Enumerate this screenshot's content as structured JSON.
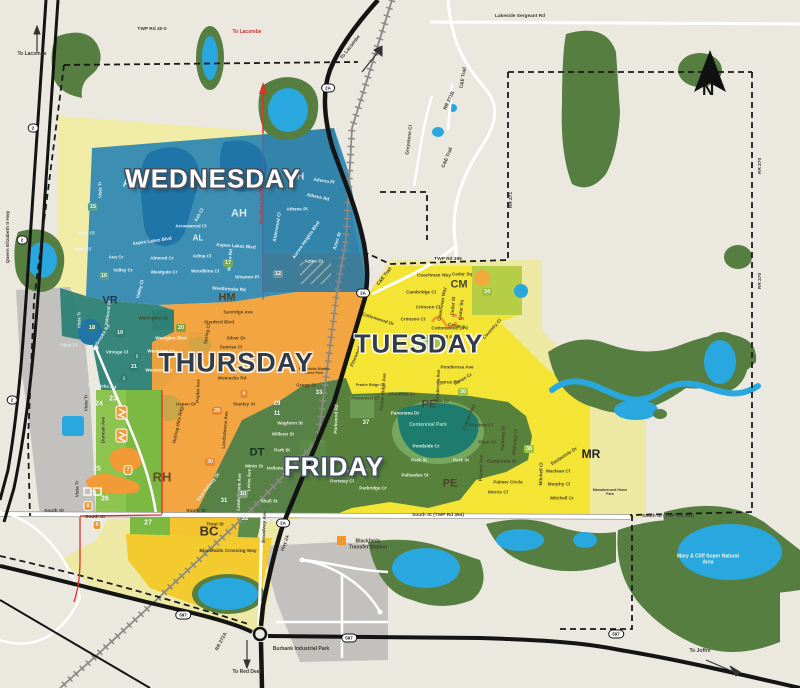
{
  "map_name": "town-collection-day-zone-map",
  "colors": {
    "background": "#EBE8E0",
    "wednesday_blue": "#2E86AF",
    "thursday_orange": "#F2A23B",
    "tuesday_yellow": "#F4E32F",
    "friday_green": "#4E7A3C",
    "pale_yellow": "#EDE9A5",
    "bright_green": "#7CB942",
    "teal_zone": "#2C8175",
    "forest": "#567E41",
    "water": "#29A8DF",
    "industrial_gray": "#C2C1BD",
    "road_red": "#E03127"
  },
  "north": {
    "t": "N"
  },
  "day_zones": [
    {
      "t": "WEDNESDAY",
      "x": 213,
      "y": 179,
      "style": "light",
      "s": 26
    },
    {
      "t": "THURSDAY",
      "x": 236,
      "y": 363,
      "style": "dark",
      "s": 27
    },
    {
      "t": "TUESDAY",
      "x": 419,
      "y": 344,
      "style": "dark",
      "s": 26
    },
    {
      "t": "FRIDAY",
      "x": 334,
      "y": 467,
      "style": "light",
      "s": 26
    }
  ],
  "area_codes": [
    {
      "t": "AL",
      "x": 130,
      "y": 184,
      "s": 11,
      "c": "#D8ECF4"
    },
    {
      "t": "AL",
      "x": 198,
      "y": 238,
      "s": 8,
      "c": "#D8ECF4"
    },
    {
      "t": "AH",
      "x": 297,
      "y": 177,
      "s": 10,
      "c": "#D8ECF4"
    },
    {
      "t": "AH",
      "x": 239,
      "y": 214,
      "s": 11,
      "c": "#D8ECF4"
    },
    {
      "t": "VR",
      "x": 110,
      "y": 301,
      "s": 11,
      "c": "#1F3B54"
    },
    {
      "t": "HM",
      "x": 227,
      "y": 298,
      "s": 11,
      "c": "#54421F"
    },
    {
      "t": "CM",
      "x": 459,
      "y": 285,
      "s": 11,
      "c": "#4A452E"
    },
    {
      "t": "PE",
      "x": 429,
      "y": 405,
      "s": 11,
      "c": "#4A452E"
    },
    {
      "t": "PE",
      "x": 450,
      "y": 484,
      "s": 11,
      "c": "#4A452E"
    },
    {
      "t": "RH",
      "x": 162,
      "y": 478,
      "s": 13,
      "c": "#6B4A23"
    },
    {
      "t": "DT",
      "x": 257,
      "y": 453,
      "s": 11,
      "c": "#17301F"
    },
    {
      "t": "BC",
      "x": 209,
      "y": 532,
      "s": 13,
      "c": "#37352C"
    },
    {
      "t": "MR",
      "x": 591,
      "y": 455,
      "s": 12,
      "c": "#22211C"
    }
  ],
  "badges": [
    {
      "t": "15",
      "x": 93,
      "y": 207,
      "bg": "#55A08F"
    },
    {
      "t": "16",
      "x": 104,
      "y": 276,
      "bg": "#55A08F"
    },
    {
      "t": "17",
      "x": 228,
      "y": 263,
      "bg": "#79A855"
    },
    {
      "t": "12",
      "x": 278,
      "y": 274,
      "bg": "#7195A0"
    },
    {
      "t": "18",
      "x": 92,
      "y": 328,
      "bg": "#2F7F72"
    },
    {
      "t": "19",
      "x": 120,
      "y": 333,
      "bg": "#2F7F72"
    },
    {
      "t": "20",
      "x": 181,
      "y": 328,
      "bg": "#7FA33C"
    },
    {
      "t": "2",
      "x": 137,
      "y": 356,
      "bg": "#2F7F72",
      "s": 4.5
    },
    {
      "t": "21",
      "x": 134,
      "y": 367,
      "bg": "#2F7F72"
    },
    {
      "t": "1",
      "x": 124,
      "y": 378,
      "bg": "#2F7F72",
      "s": 4.5
    },
    {
      "t": "4",
      "x": 244,
      "y": 394,
      "bg": "#E8882F"
    },
    {
      "t": "28",
      "x": 217,
      "y": 411,
      "bg": "#E8882F"
    },
    {
      "t": "30",
      "x": 210,
      "y": 462,
      "bg": "#E8882F"
    },
    {
      "t": "23",
      "x": 113,
      "y": 399,
      "bg": "none",
      "s": 7
    },
    {
      "t": "24",
      "x": 99,
      "y": 404,
      "bg": "none",
      "s": 7
    },
    {
      "t": "25",
      "x": 97,
      "y": 469,
      "bg": "none",
      "s": 7
    },
    {
      "t": "26",
      "x": 105,
      "y": 499,
      "bg": "none",
      "s": 7
    },
    {
      "t": "27",
      "x": 148,
      "y": 523,
      "bg": "none",
      "s": 7
    },
    {
      "t": "7",
      "x": 128,
      "y": 470,
      "bg": "#F09A30",
      "brd": 1
    },
    {
      "t": "8",
      "x": 88,
      "y": 506,
      "bg": "#F09A30",
      "brd": 1
    },
    {
      "t": "9",
      "x": 97,
      "y": 525,
      "bg": "#F09A30",
      "brd": 1
    },
    {
      "t": "10",
      "x": 243,
      "y": 494,
      "bg": "#84A284"
    },
    {
      "t": "31",
      "x": 224,
      "y": 501,
      "bg": "none",
      "s": 6
    },
    {
      "t": "32",
      "x": 245,
      "y": 519,
      "bg": "none",
      "s": 6
    },
    {
      "t": "29",
      "x": 277,
      "y": 404,
      "bg": "none",
      "s": 6
    },
    {
      "t": "11",
      "x": 277,
      "y": 414,
      "bg": "none",
      "s": 6
    },
    {
      "t": "33",
      "x": 319,
      "y": 393,
      "bg": "none",
      "s": 6
    },
    {
      "t": "34",
      "x": 487,
      "y": 292,
      "bg": "#9DC43B"
    },
    {
      "t": "36",
      "x": 463,
      "y": 392,
      "bg": "#9DC43B"
    },
    {
      "t": "37",
      "x": 366,
      "y": 423,
      "bg": "none",
      "s": 6
    },
    {
      "t": "38",
      "x": 529,
      "y": 449,
      "bg": "#9DC43B"
    }
  ],
  "shields": [
    {
      "t": "2A",
      "x": 328,
      "y": 88
    },
    {
      "t": "2A",
      "x": 363,
      "y": 293
    },
    {
      "t": "2A",
      "x": 283,
      "y": 523
    },
    {
      "t": "2",
      "x": 33,
      "y": 128
    },
    {
      "t": "2",
      "x": 22,
      "y": 240
    },
    {
      "t": "2",
      "x": 12,
      "y": 400
    },
    {
      "t": "597",
      "x": 183,
      "y": 615
    },
    {
      "t": "597",
      "x": 349,
      "y": 638
    },
    {
      "t": "597",
      "x": 616,
      "y": 634
    }
  ],
  "roads": [
    {
      "t": "Lakeside Sergeant Rd",
      "x": 520,
      "y": 17
    },
    {
      "t": "TWP Rd 40-0",
      "x": 152,
      "y": 30
    },
    {
      "t": "TWP Rd 395",
      "x": 448,
      "y": 260
    },
    {
      "t": "South St",
      "x": 54,
      "y": 512
    },
    {
      "t": "South St",
      "x": 95,
      "y": 518
    },
    {
      "t": "South St",
      "x": 196,
      "y": 512
    },
    {
      "t": "South St (TWP Rd 394)",
      "x": 438,
      "y": 516,
      "b": 1
    },
    {
      "t": "South St (TWP Rd 394)",
      "x": 668,
      "y": 517,
      "b": 1
    },
    {
      "t": "Queen Elizabeth II Hwy",
      "x": 9,
      "y": 237,
      "r": -90
    },
    {
      "t": "C&E Trail",
      "x": 464,
      "y": 78,
      "r": -80
    },
    {
      "t": "C&E Trail",
      "x": 448,
      "y": 158,
      "r": -68
    },
    {
      "t": "C&E Trail",
      "x": 385,
      "y": 277,
      "r": -52
    },
    {
      "t": "Greystone Cl",
      "x": 410,
      "y": 140,
      "r": -83
    },
    {
      "t": "RR 271B",
      "x": 450,
      "y": 101,
      "r": -65
    },
    {
      "t": "RR 271",
      "x": 512,
      "y": 200,
      "r": -90
    },
    {
      "t": "RR 270",
      "x": 761,
      "y": 166,
      "r": -90
    },
    {
      "t": "RR 270",
      "x": 761,
      "y": 281,
      "r": -90
    },
    {
      "t": "RR 272A",
      "x": 222,
      "y": 642,
      "r": -62
    },
    {
      "t": "Blackfalds Crossing Way",
      "x": 228,
      "y": 552,
      "b": 1
    }
  ],
  "places": [
    {
      "t": "To Lacombe",
      "x": 32,
      "y": 55,
      "b": 1
    },
    {
      "t": "To Lacombe",
      "x": 247,
      "y": 33,
      "b": 1,
      "c": "#C8362E"
    },
    {
      "t": "To Lacombe",
      "x": 351,
      "y": 48,
      "b": 1,
      "r": -52
    },
    {
      "t": "To Red Deer",
      "x": 247,
      "y": 673,
      "b": 1
    },
    {
      "t": "To Joffre",
      "x": 700,
      "y": 652,
      "b": 1
    },
    {
      "t": "Burbank Industrial Park",
      "x": 301,
      "y": 650,
      "b": 1,
      "s": 5
    },
    {
      "t": "Blackfalds Transfer Station",
      "x": 368,
      "y": 545,
      "b": 1,
      "wd": 44
    },
    {
      "t": "Mary & Cliff Soper Natural Area",
      "x": 708,
      "y": 560,
      "b": 1,
      "c": "#F2F7EC",
      "wd": 64
    },
    {
      "t": "Centennial Park",
      "x": 428,
      "y": 426,
      "c": "#9FD9C8",
      "wd": 40
    },
    {
      "t": "Blackfalds Mobile Home Park",
      "x": 314,
      "y": 371,
      "c": "#54421F",
      "wd": 40,
      "s": 3.6
    },
    {
      "t": "Manufactured Home Park",
      "x": 610,
      "y": 492,
      "c": "#3E3A33",
      "wd": 42,
      "s": 3.6
    }
  ],
  "streets": [
    {
      "t": "Vista Tr",
      "x": 100,
      "y": 190,
      "r": -90,
      "c": "#EAF4F8"
    },
    {
      "t": "Anna Cl",
      "x": 86,
      "y": 233,
      "c": "#EAF4F8"
    },
    {
      "t": "Arlen Cl",
      "x": 82,
      "y": 249,
      "c": "#EAF4F8"
    },
    {
      "t": "Ava Cr",
      "x": 116,
      "y": 257,
      "c": "#EAF4F8"
    },
    {
      "t": "Aspen Lakes Blvd",
      "x": 152,
      "y": 241,
      "r": -8,
      "c": "#EAF4F8"
    },
    {
      "t": "Aspen Lakes Blvd",
      "x": 236,
      "y": 246,
      "r": 4,
      "c": "#EAF4F8"
    },
    {
      "t": "Almond Cr",
      "x": 162,
      "y": 258,
      "c": "#EAF4F8"
    },
    {
      "t": "Westgate Cr",
      "x": 164,
      "y": 272,
      "c": "#EAF4F8"
    },
    {
      "t": "Valley Cr",
      "x": 123,
      "y": 270,
      "c": "#EAF4F8"
    },
    {
      "t": "Valley Cl",
      "x": 140,
      "y": 289,
      "r": -75,
      "c": "#EAF4F8"
    },
    {
      "t": "Adina Cl",
      "x": 202,
      "y": 256,
      "c": "#EAF4F8"
    },
    {
      "t": "Woodbine Cl",
      "x": 205,
      "y": 271,
      "c": "#EAF4F8"
    },
    {
      "t": "Winston Pl",
      "x": 247,
      "y": 277,
      "c": "#EAF4F8"
    },
    {
      "t": "Westbrooke Rd",
      "x": 229,
      "y": 289,
      "r": 3,
      "c": "#EAF4F8"
    },
    {
      "t": "Arrowwood Cl",
      "x": 191,
      "y": 226,
      "c": "#EAF4F8"
    },
    {
      "t": "Ash Cl",
      "x": 199,
      "y": 215,
      "r": -60,
      "c": "#EAF4F8"
    },
    {
      "t": "Willow Rd",
      "x": 230,
      "y": 260,
      "r": -85,
      "c": "#EAF4F8"
    },
    {
      "t": "Athena Pl",
      "x": 324,
      "y": 181,
      "r": 8,
      "c": "#EAF4F8"
    },
    {
      "t": "Athens Rd",
      "x": 318,
      "y": 197,
      "r": 12,
      "c": "#EAF4F8"
    },
    {
      "t": "Athens Pl",
      "x": 297,
      "y": 209,
      "c": "#EAF4F8"
    },
    {
      "t": "Alderwood Cl",
      "x": 277,
      "y": 227,
      "r": -80,
      "c": "#EAF4F8"
    },
    {
      "t": "Aurora Heights Blvd",
      "x": 306,
      "y": 240,
      "r": -55,
      "c": "#EAF4F8"
    },
    {
      "t": "Aztec St",
      "x": 337,
      "y": 241,
      "r": -72,
      "c": "#EAF4F8"
    },
    {
      "t": "Aztec Cr",
      "x": 314,
      "y": 261,
      "c": "#EAF4F8"
    },
    {
      "t": "Broadway Ave/RR 272",
      "x": 261,
      "y": 200,
      "r": -90,
      "c": "#C8362E"
    },
    {
      "t": "Vista Tr",
      "x": 79,
      "y": 320,
      "r": -90,
      "c": "#DDEEEA"
    },
    {
      "t": "Valmond St",
      "x": 108,
      "y": 313,
      "r": -82,
      "c": "#DDEEEA"
    },
    {
      "t": "Vista Cl",
      "x": 69,
      "y": 345,
      "c": "#DDEEEA"
    },
    {
      "t": "Westbrooke Rd",
      "x": 100,
      "y": 339,
      "r": -58,
      "c": "#DDEEEA"
    },
    {
      "t": "Vintage Cl",
      "x": 117,
      "y": 352,
      "c": "#DDEEEA"
    },
    {
      "t": "Womacks Rd",
      "x": 102,
      "y": 386,
      "r": 6,
      "c": "#DDEEEA"
    },
    {
      "t": "Wellington Cl",
      "x": 153,
      "y": 318,
      "c": "#54421F"
    },
    {
      "t": "Sunridge Ave",
      "x": 238,
      "y": 312,
      "c": "#54421F"
    },
    {
      "t": "Stanford Blvd",
      "x": 219,
      "y": 322,
      "c": "#54421F"
    },
    {
      "t": "Silver Dr",
      "x": 236,
      "y": 338,
      "c": "#54421F"
    },
    {
      "t": "Sunrise Cl",
      "x": 231,
      "y": 347,
      "c": "#54421F"
    },
    {
      "t": "Spring Cl",
      "x": 207,
      "y": 334,
      "r": -80,
      "c": "#54421F"
    },
    {
      "t": "Westglen Blvd",
      "x": 171,
      "y": 338,
      "c": "#FFF8EC"
    },
    {
      "t": "Westview Cr",
      "x": 161,
      "y": 351,
      "c": "#FFF8EC"
    },
    {
      "t": "Westview Cr",
      "x": 159,
      "y": 370,
      "c": "#FFF8EC"
    },
    {
      "t": "Womacks Rd",
      "x": 232,
      "y": 378,
      "c": "#54421F"
    },
    {
      "t": "Stanley St",
      "x": 244,
      "y": 404,
      "c": "#54421F"
    },
    {
      "t": "Aspen Dr",
      "x": 186,
      "y": 404,
      "c": "#54421F"
    },
    {
      "t": "Poplar Ave",
      "x": 198,
      "y": 391,
      "r": -88,
      "c": "#54421F"
    },
    {
      "t": "Rolling Hills Rdg",
      "x": 178,
      "y": 425,
      "r": -78,
      "c": "#54421F"
    },
    {
      "t": "Landsdowne Ave",
      "x": 225,
      "y": 430,
      "r": -85,
      "c": "#54421F"
    },
    {
      "t": "Gregg St",
      "x": 306,
      "y": 385,
      "c": "#54421F"
    },
    {
      "t": "Coachman Way",
      "x": 434,
      "y": 275,
      "c": "#4A452E"
    },
    {
      "t": "Cedar Sq",
      "x": 462,
      "y": 274,
      "c": "#4A452E"
    },
    {
      "t": "Cambridge Cl",
      "x": 421,
      "y": 292,
      "c": "#4A452E"
    },
    {
      "t": "Crimson Cl",
      "x": 428,
      "y": 307,
      "c": "#4A452E"
    },
    {
      "t": "Crimson Ct",
      "x": 413,
      "y": 319,
      "c": "#4A452E"
    },
    {
      "t": "Coachman Way",
      "x": 442,
      "y": 304,
      "r": -80,
      "c": "#4A452E"
    },
    {
      "t": "Cedar St",
      "x": 453,
      "y": 306,
      "r": -85,
      "c": "#4A452E"
    },
    {
      "t": "Cedar Sq",
      "x": 461,
      "y": 310,
      "r": -85,
      "c": "#4A452E"
    },
    {
      "t": "Cedar Sq",
      "x": 458,
      "y": 326,
      "r": 10,
      "c": "#4A452E"
    },
    {
      "t": "Cottonwood Dr",
      "x": 448,
      "y": 328,
      "c": "#4A452E"
    },
    {
      "t": "Cottonwood Dr",
      "x": 378,
      "y": 319,
      "r": 18,
      "c": "#4A452E"
    },
    {
      "t": "Churchill Pl",
      "x": 441,
      "y": 337,
      "c": "#4A452E"
    },
    {
      "t": "Coventry Cl",
      "x": 492,
      "y": 329,
      "r": -48,
      "c": "#4A452E"
    },
    {
      "t": "Ponderosa Ave",
      "x": 457,
      "y": 367,
      "c": "#4A452E"
    },
    {
      "t": "Ponderosa Ave",
      "x": 438,
      "y": 386,
      "r": -88,
      "c": "#4A452E"
    },
    {
      "t": "Cyprus Rd",
      "x": 448,
      "y": 382,
      "c": "#4A452E"
    },
    {
      "t": "Inman Cr",
      "x": 463,
      "y": 379,
      "r": -30,
      "c": "#4A452E"
    },
    {
      "t": "Plumtree Cr",
      "x": 402,
      "y": 394,
      "c": "#4A452E"
    },
    {
      "t": "Prairie Ridge Ave",
      "x": 383,
      "y": 392,
      "r": -85,
      "c": "#4A452E"
    },
    {
      "t": "Prairie Ridge Cl",
      "x": 370,
      "y": 385,
      "s": 3.8,
      "c": "#4A452E"
    },
    {
      "t": "Pinewood Cl",
      "x": 365,
      "y": 398,
      "c": "#4A452E"
    },
    {
      "t": "Pinewood Rd",
      "x": 357,
      "y": 353,
      "r": -68,
      "c": "#4A452E"
    },
    {
      "t": "Pine Cr",
      "x": 441,
      "y": 401,
      "c": "#4A452E"
    },
    {
      "t": "Pioneer Way",
      "x": 469,
      "y": 417,
      "r": -68,
      "c": "#4A452E"
    },
    {
      "t": "Pinetree Cl",
      "x": 481,
      "y": 425,
      "c": "#4A452E"
    },
    {
      "t": "Piper Cl",
      "x": 487,
      "y": 442,
      "c": "#4A452E"
    },
    {
      "t": "Parkway Dr",
      "x": 503,
      "y": 438,
      "r": -88,
      "c": "#4A452E"
    },
    {
      "t": "McKinley Cl",
      "x": 515,
      "y": 442,
      "r": -85,
      "c": "#4A452E"
    },
    {
      "t": "Eastpointe Dr",
      "x": 502,
      "y": 461,
      "c": "#4A452E"
    },
    {
      "t": "Eastpointe Dr",
      "x": 564,
      "y": 456,
      "r": -32,
      "c": "#4A452E"
    },
    {
      "t": "Pioneer Ave",
      "x": 481,
      "y": 468,
      "r": -88,
      "c": "#4A452E"
    },
    {
      "t": "Palmer Circle",
      "x": 508,
      "y": 482,
      "c": "#4A452E"
    },
    {
      "t": "Morris Cl",
      "x": 498,
      "y": 492,
      "c": "#4A452E"
    },
    {
      "t": "Mitchell Cl",
      "x": 541,
      "y": 474,
      "r": -88,
      "c": "#4A452E"
    },
    {
      "t": "Maclean Cl",
      "x": 558,
      "y": 471,
      "c": "#4A452E"
    },
    {
      "t": "Murphy Cl",
      "x": 559,
      "y": 484,
      "c": "#4A452E"
    },
    {
      "t": "Mitchell Cr",
      "x": 562,
      "y": 498,
      "c": "#4A452E"
    },
    {
      "t": "Panorama Dr",
      "x": 405,
      "y": 413,
      "c": "#E8F2E4"
    },
    {
      "t": "Pondside Cr",
      "x": 426,
      "y": 446,
      "c": "#E8F2E4"
    },
    {
      "t": "Park St",
      "x": 419,
      "y": 460,
      "c": "#E8F2E4"
    },
    {
      "t": "Park St",
      "x": 461,
      "y": 460,
      "c": "#E8F2E4"
    },
    {
      "t": "Palisades St",
      "x": 415,
      "y": 475,
      "c": "#E8F2E4"
    },
    {
      "t": "Pinnacle Cl",
      "x": 355,
      "y": 471,
      "c": "#E8F2E4"
    },
    {
      "t": "Portway Cl",
      "x": 342,
      "y": 481,
      "c": "#E8F2E4"
    },
    {
      "t": "Parkridge Cr",
      "x": 373,
      "y": 488,
      "c": "#E8F2E4"
    },
    {
      "t": "Parkwood Rd",
      "x": 336,
      "y": 419,
      "r": -88,
      "c": "#E8F2E4"
    },
    {
      "t": "Waghorn St",
      "x": 290,
      "y": 423,
      "c": "#E8F2E4"
    },
    {
      "t": "Willson St",
      "x": 283,
      "y": 434,
      "c": "#E8F2E4"
    },
    {
      "t": "Park St",
      "x": 282,
      "y": 450,
      "c": "#E8F2E4"
    },
    {
      "t": "Indiana St",
      "x": 278,
      "y": 468,
      "c": "#E8F2E4"
    },
    {
      "t": "Minto St",
      "x": 254,
      "y": 466,
      "c": "#E8F2E4"
    },
    {
      "t": "Shull St",
      "x": 269,
      "y": 501,
      "c": "#E8F2E4"
    },
    {
      "t": "Lorne Ave",
      "x": 249,
      "y": 480,
      "r": -88,
      "c": "#E8F2E4"
    },
    {
      "t": "Landsdowne Ave",
      "x": 239,
      "y": 492,
      "r": -88,
      "c": "#E8F2E4"
    },
    {
      "t": "East Railway St",
      "x": 208,
      "y": 487,
      "r": -52,
      "c": "#E8F2E4"
    },
    {
      "t": "Broadway Ave",
      "x": 264,
      "y": 527,
      "r": -88
    },
    {
      "t": "Hwy 2A",
      "x": 285,
      "y": 543,
      "r": -70
    },
    {
      "t": "Trout St",
      "x": 215,
      "y": 524
    },
    {
      "t": "Duncan Ave",
      "x": 103,
      "y": 430,
      "r": -90
    },
    {
      "t": "Vista Tr",
      "x": 86,
      "y": 403,
      "r": -90
    },
    {
      "t": "Vista Tr",
      "x": 77,
      "y": 489,
      "r": -90
    }
  ]
}
